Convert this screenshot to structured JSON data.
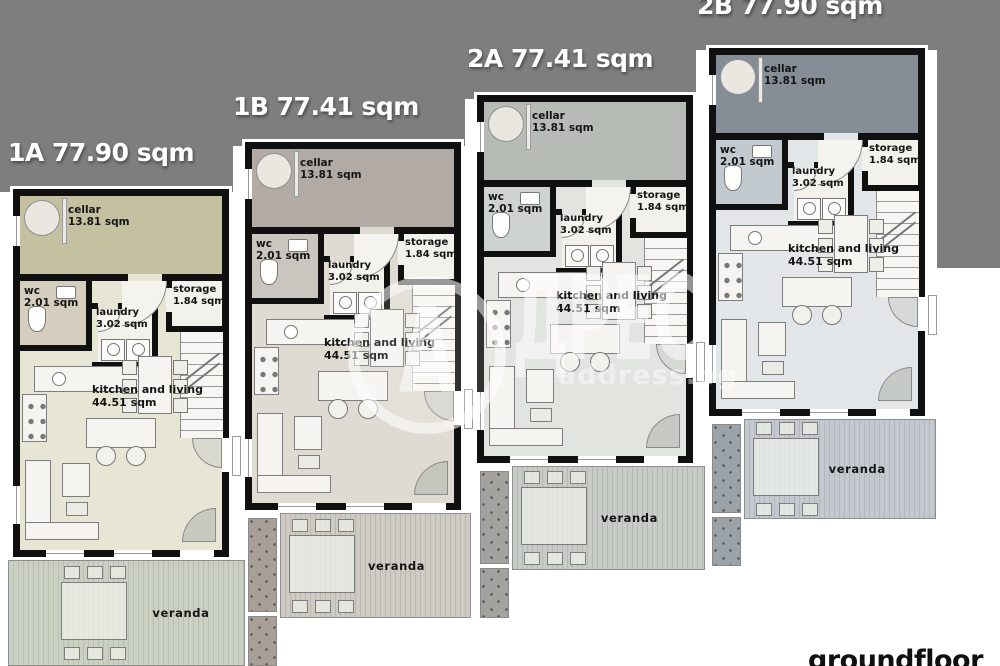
{
  "plan": {
    "floor_label": "groundfloor",
    "backdrop_color": "#7e7e7e",
    "wall_color": "#101010",
    "background_color": "#ffffff"
  },
  "watermark": {
    "initial": "А",
    "rest": "ДРЕС",
    "domain": "address.bg"
  },
  "units": [
    {
      "id": "1A",
      "title": "1A 77.90 sqm",
      "colors": {
        "cellar": "#c5c0a0",
        "living": "#e7e5d4",
        "wc": "#d5cdbd",
        "veranda_a": "#cbd1c2",
        "veranda_b": "#b8bfae"
      },
      "rooms": {
        "cellar": {
          "name": "cellar",
          "area": "13.81 sqm"
        },
        "wc": {
          "name": "wc",
          "area": "2.01 sqm"
        },
        "laundry": {
          "name": "laundry",
          "area": "3.02 sqm"
        },
        "storage": {
          "name": "storage",
          "area": "1.84 sqm"
        },
        "living": {
          "name": "kitchen and living",
          "area": "44.51 sqm"
        },
        "veranda": {
          "name": "veranda"
        }
      }
    },
    {
      "id": "1B",
      "title": "1B 77.41 sqm",
      "colors": {
        "cellar": "#b2aba5",
        "living": "#dfdbd2",
        "wc": "#cac5be",
        "veranda_a": "#cecbc3",
        "veranda_b": "#bcb8b0"
      },
      "rooms": {
        "cellar": {
          "name": "cellar",
          "area": "13.81 sqm"
        },
        "wc": {
          "name": "wc",
          "area": "2.01 sqm"
        },
        "laundry": {
          "name": "laundry",
          "area": "3.02 sqm"
        },
        "storage": {
          "name": "storage",
          "area": "1.84 sqm"
        },
        "living": {
          "name": "kitchen and living",
          "area": "44.51 sqm"
        },
        "veranda": {
          "name": "veranda"
        }
      }
    },
    {
      "id": "2A",
      "title": "2A 77.41 sqm",
      "colors": {
        "cellar": "#b6bbb5",
        "living": "#e2e4df",
        "wc": "#ced3d0",
        "veranda_a": "#c7ccc6",
        "veranda_b": "#b4bab3"
      },
      "rooms": {
        "cellar": {
          "name": "cellar",
          "area": "13.81 sqm"
        },
        "wc": {
          "name": "wc",
          "area": "2.01 sqm"
        },
        "laundry": {
          "name": "laundry",
          "area": "3.02 sqm"
        },
        "storage": {
          "name": "storage",
          "area": "1.84 sqm"
        },
        "living": {
          "name": "kitchen and living",
          "area": "44.51 sqm"
        },
        "veranda": {
          "name": "veranda"
        }
      }
    },
    {
      "id": "2B",
      "title": "2B 77.90 sqm",
      "colors": {
        "cellar": "#858e96",
        "living": "#e3e6e8",
        "wc": "#c2c9cf",
        "veranda_a": "#c3c9ce",
        "veranda_b": "#b0b8be"
      },
      "rooms": {
        "cellar": {
          "name": "cellar",
          "area": "13.81 sqm"
        },
        "wc": {
          "name": "wc",
          "area": "2.01 sqm"
        },
        "laundry": {
          "name": "laundry",
          "area": "3.02 sqm"
        },
        "storage": {
          "name": "storage",
          "area": "1.84 sqm"
        },
        "living": {
          "name": "kitchen and living",
          "area": "44.51 sqm"
        },
        "veranda": {
          "name": "veranda"
        }
      }
    }
  ]
}
